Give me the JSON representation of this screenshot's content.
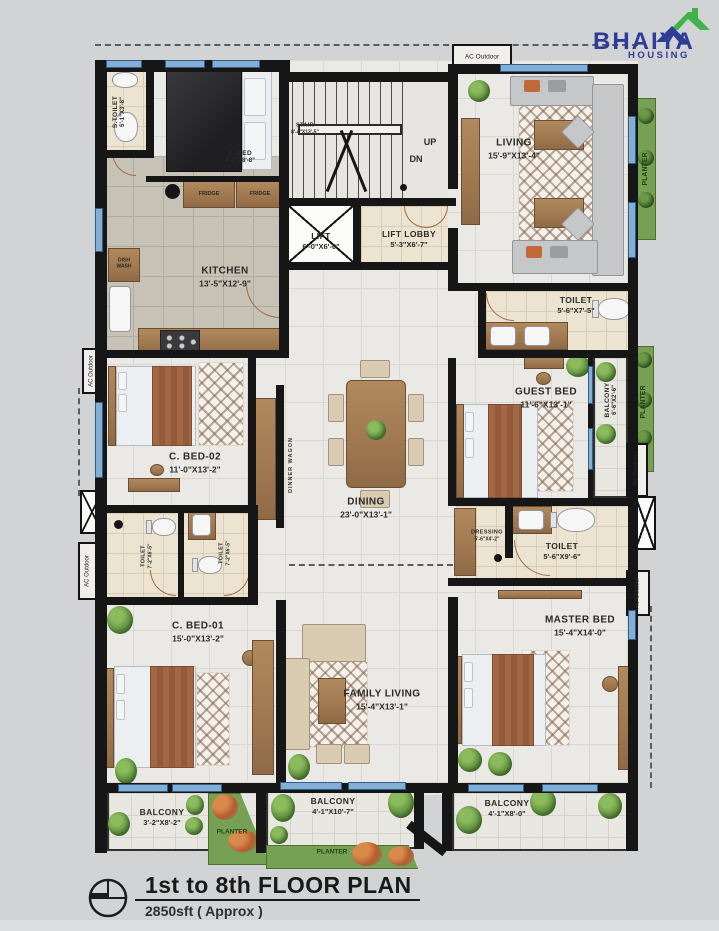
{
  "logo": {
    "brand": "BHAIYA",
    "sub": "HOUSING",
    "brand_color": "#2e3b97",
    "roof_green": "#3eb449",
    "roof_blue": "#2e3b97"
  },
  "title_block": {
    "title": "1st to 8th FLOOR PLAN",
    "subtitle": "2850sft ( Approx )"
  },
  "labels": {
    "ac_outdoor": "AC Outdoor",
    "planter": "PLANTER",
    "fridge": "FRIDGE",
    "dish_wash": "DISH WASH",
    "dinner_wagon": "DINNER WAGON",
    "up": "UP",
    "dn": "DN"
  },
  "rooms": {
    "s_toilet": {
      "name": "S.TOILET",
      "dims": "5'-1\"X3'-8\""
    },
    "s_bed": {
      "name": "S. BED",
      "dims": "9'-0\"X8'-8\""
    },
    "stair": {
      "name": "STAIR",
      "dims": "8'-4\"X13'-5\""
    },
    "lift": {
      "name": "LIFT",
      "dims": "6'-0\"X6'-0\""
    },
    "lift_lobby": {
      "name": "LIFT LOBBY",
      "dims": "5'-3\"X6'-7\""
    },
    "living": {
      "name": "LIVING",
      "dims": "15'-9\"X13'-4\""
    },
    "kitchen": {
      "name": "KITCHEN",
      "dims": "13'-5\"X12'-9\""
    },
    "toilet_top": {
      "name": "TOILET",
      "dims": "5'-6\"X7'-5\""
    },
    "guest_bed": {
      "name": "GUEST BED",
      "dims": "11'-6\"X13'-1\""
    },
    "balcony_guest": {
      "name": "BALCONY",
      "dims": "6'-6\"X2'-6\""
    },
    "c_bed_02": {
      "name": "C. BED-02",
      "dims": "11'-0\"X13'-2\""
    },
    "dining": {
      "name": "DINING",
      "dims": "23'-0\"X13'-1\""
    },
    "toilet_mid_l": {
      "name": "TOILET",
      "dims": "7'-2\"X6'-5\""
    },
    "toilet_mid_r": {
      "name": "TOILET",
      "dims": "7'-2\"X6'-5\""
    },
    "dressing": {
      "name": "DRESSING",
      "dims": "5'-6\"X4'-2\""
    },
    "toilet_master": {
      "name": "TOILET",
      "dims": "5'-6\"X9'-6\""
    },
    "c_bed_01": {
      "name": "C. BED-01",
      "dims": "15'-0\"X13'-2\""
    },
    "family_living": {
      "name": "FAMILY LIVING",
      "dims": "15'-4\"X13'-1\""
    },
    "master_bed": {
      "name": "MASTER BED",
      "dims": "15'-4\"X14'-0\""
    },
    "balcony_left": {
      "name": "BALCONY",
      "dims": "3'-2\"X8'-2\""
    },
    "balcony_mid": {
      "name": "BALCONY",
      "dims": "4'-1\"X10'-7\""
    },
    "balcony_right": {
      "name": "BALCONY",
      "dims": "4'-1\"X8'-0\""
    }
  }
}
